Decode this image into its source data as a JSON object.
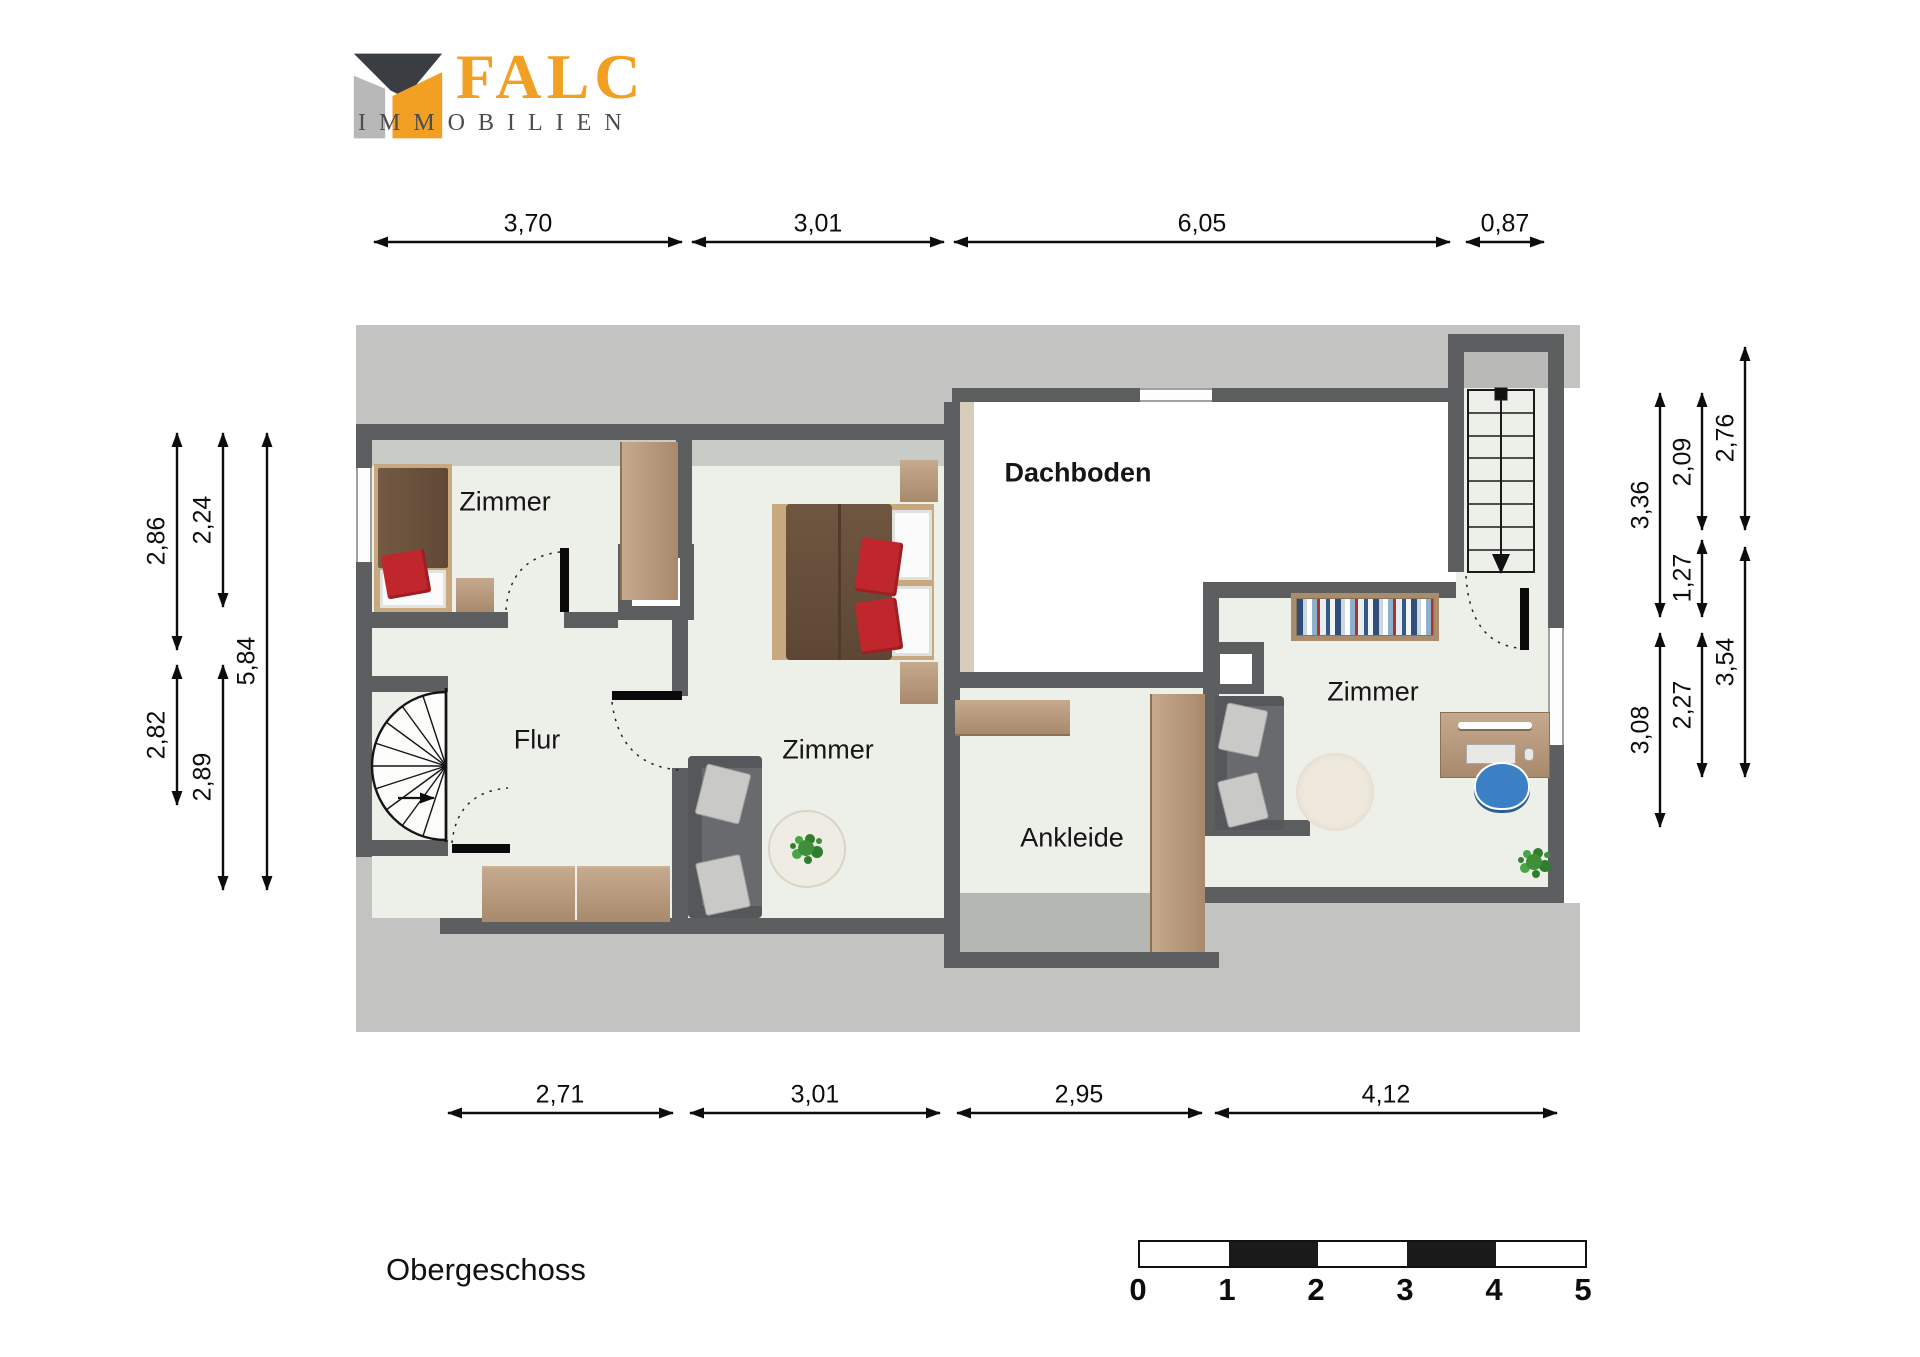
{
  "brand": {
    "name": "FALC",
    "subtitle": "IMMOBILIEN"
  },
  "title": "Obergeschoss",
  "rooms": {
    "bedroom1": "Zimmer",
    "hall": "Flur",
    "bedroom2": "Zimmer",
    "attic": "Dachboden",
    "dressing": "Ankleide",
    "office": "Zimmer"
  },
  "dimensions": {
    "top": [
      "3,70",
      "3,01",
      "6,05",
      "0,87"
    ],
    "bottom": [
      "2,71",
      "3,01",
      "2,95",
      "4,12"
    ],
    "left": [
      "2,86",
      "2,24",
      "5,84",
      "2,82",
      "2,89"
    ],
    "right": [
      "3,36",
      "2,09",
      "2,76",
      "1,27",
      "3,54",
      "3,08",
      "2,27"
    ]
  },
  "scale_bar": {
    "labels": [
      "0",
      "1",
      "2",
      "3",
      "4",
      "5"
    ]
  },
  "colors": {
    "wall": "#5c5e60",
    "floor": "#edefe9",
    "roof_area": "#c3c4c2",
    "attic_floor": "#ffffff",
    "brand_orange": "#f2a024",
    "brand_gray": "#4d4d4d",
    "wood": "#b49478",
    "accent_red": "#bf272c"
  }
}
